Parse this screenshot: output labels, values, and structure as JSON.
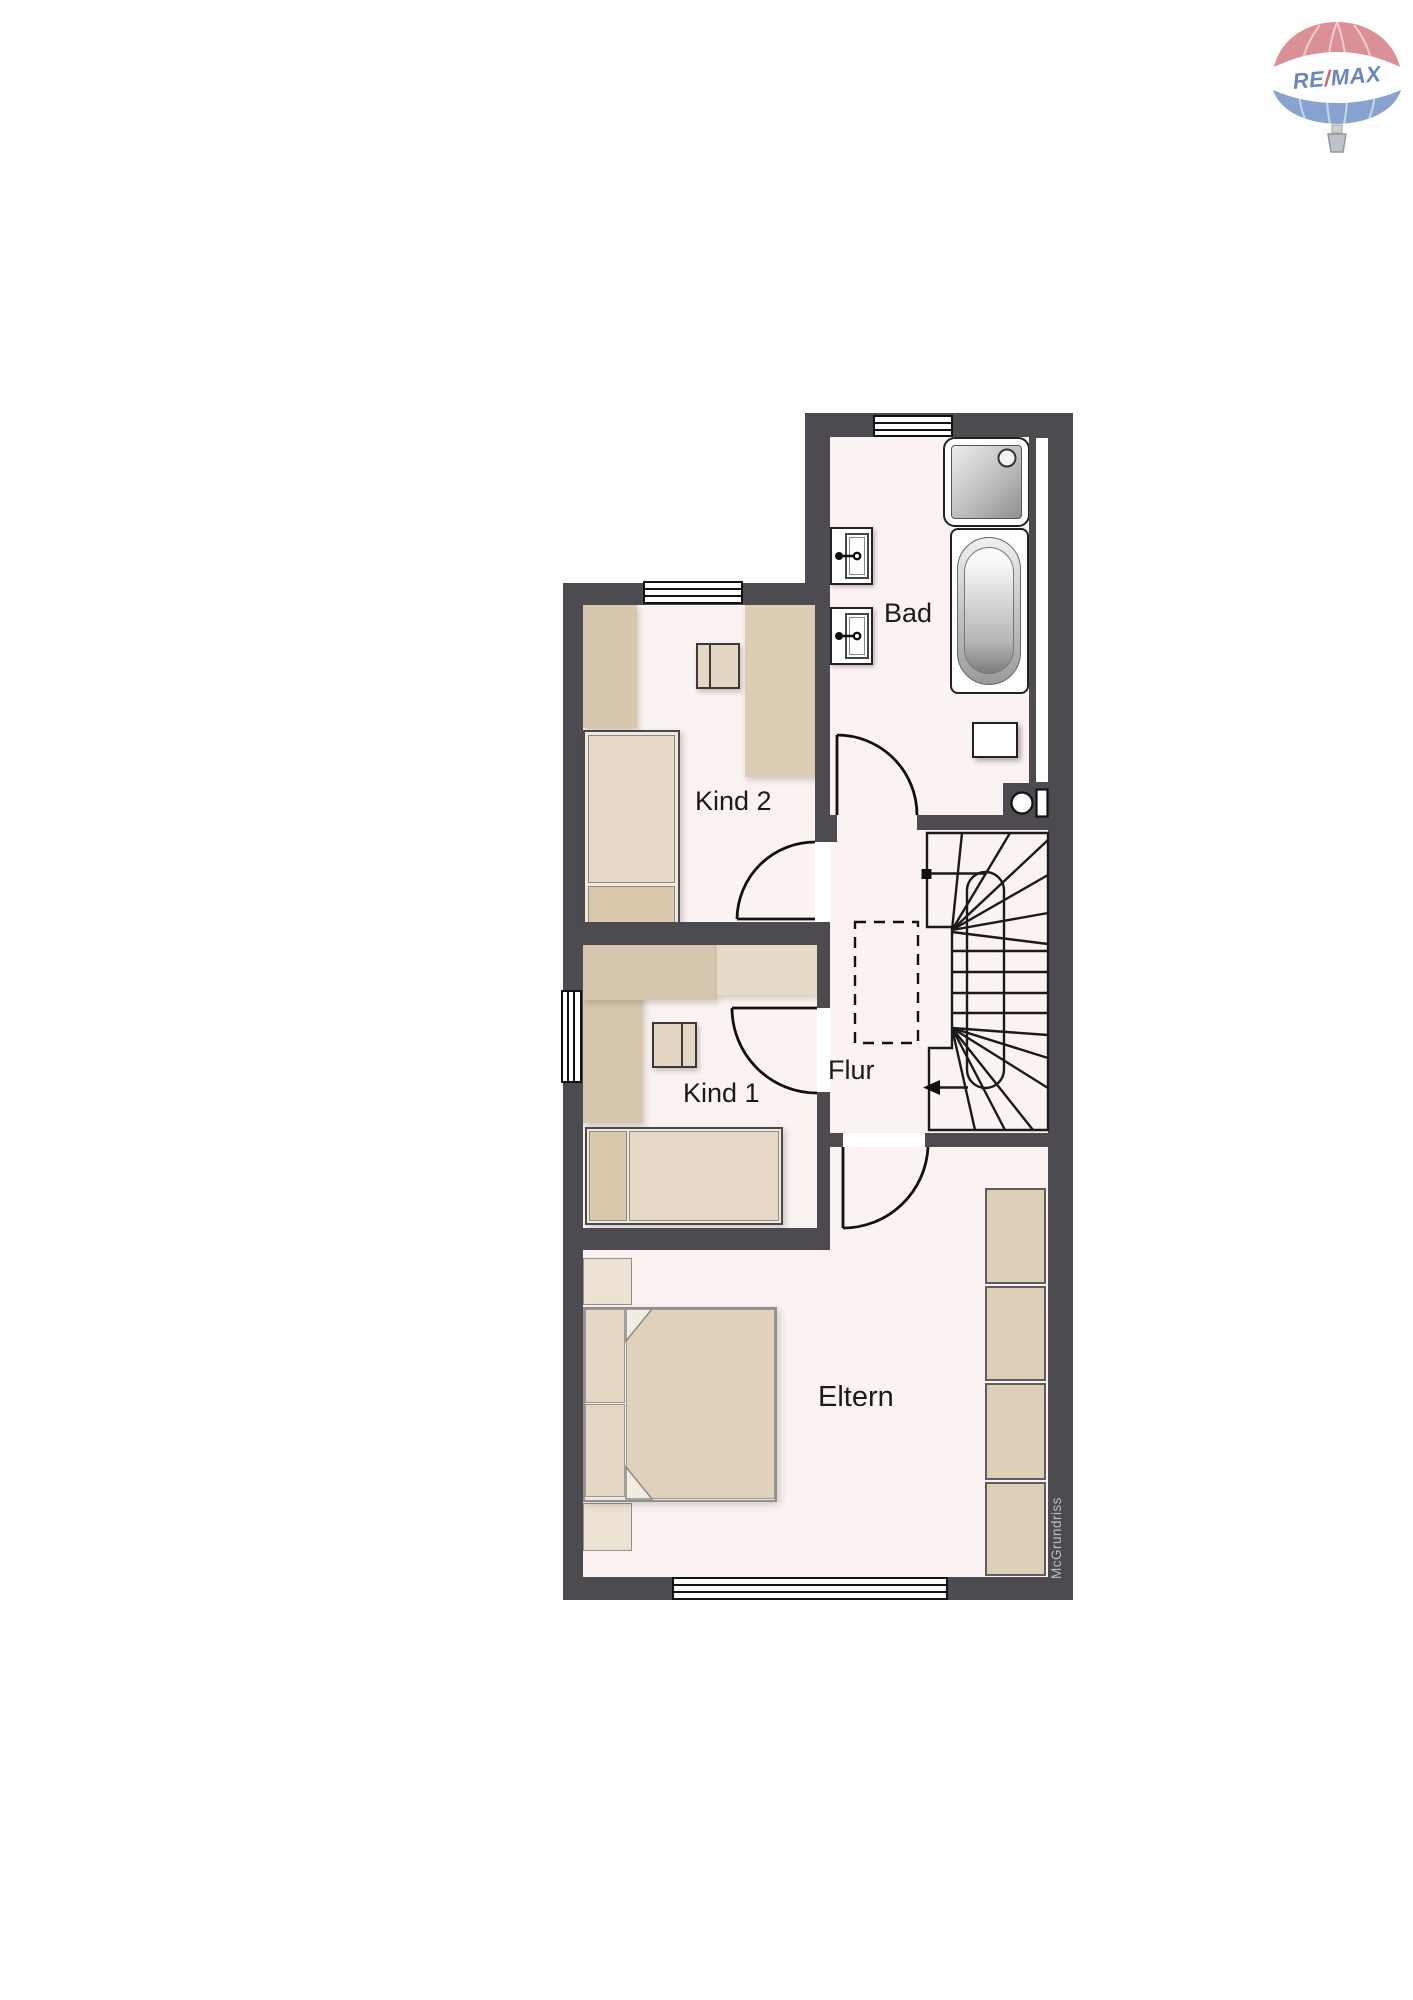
{
  "plan": {
    "type": "floorplan",
    "floor_shown": "Obergeschoss",
    "rooms": {
      "bad": {
        "label": "Bad"
      },
      "kind2": {
        "label": "Kind 2"
      },
      "kind1": {
        "label": "Kind 1"
      },
      "flur": {
        "label": "Flur"
      },
      "eltern": {
        "label": "Eltern"
      }
    },
    "fixtures": [
      "shower",
      "bathtub",
      "sink",
      "sink",
      "toilet",
      "bath-cabinet"
    ],
    "furniture": [
      "wardrobe",
      "desk",
      "chair",
      "single-bed",
      "l-desk",
      "chair",
      "single-bed",
      "nightstand",
      "double-bed",
      "nightstand",
      "wardrobe-units"
    ],
    "stairs": {
      "type": "winder-half-turn",
      "direction_marker": "arrow-down-left"
    }
  },
  "watermark": "McGrundriss",
  "logo": {
    "brand": "RE/MAX",
    "text_re": "RE",
    "text_slash": "/",
    "text_max": "MAX"
  },
  "colors": {
    "wall": "#4d4b50",
    "floor": "#fbf3f1",
    "furniture_tan": "#d7c7ae",
    "furniture_tan_light": "#e6dac8",
    "logo_red": "#d9868e",
    "logo_blue": "#7e9ccb",
    "logo_text_blue": "#5c7db8",
    "logo_slash_red": "#cf5560",
    "watermark_gray": "#bdbcbe"
  }
}
